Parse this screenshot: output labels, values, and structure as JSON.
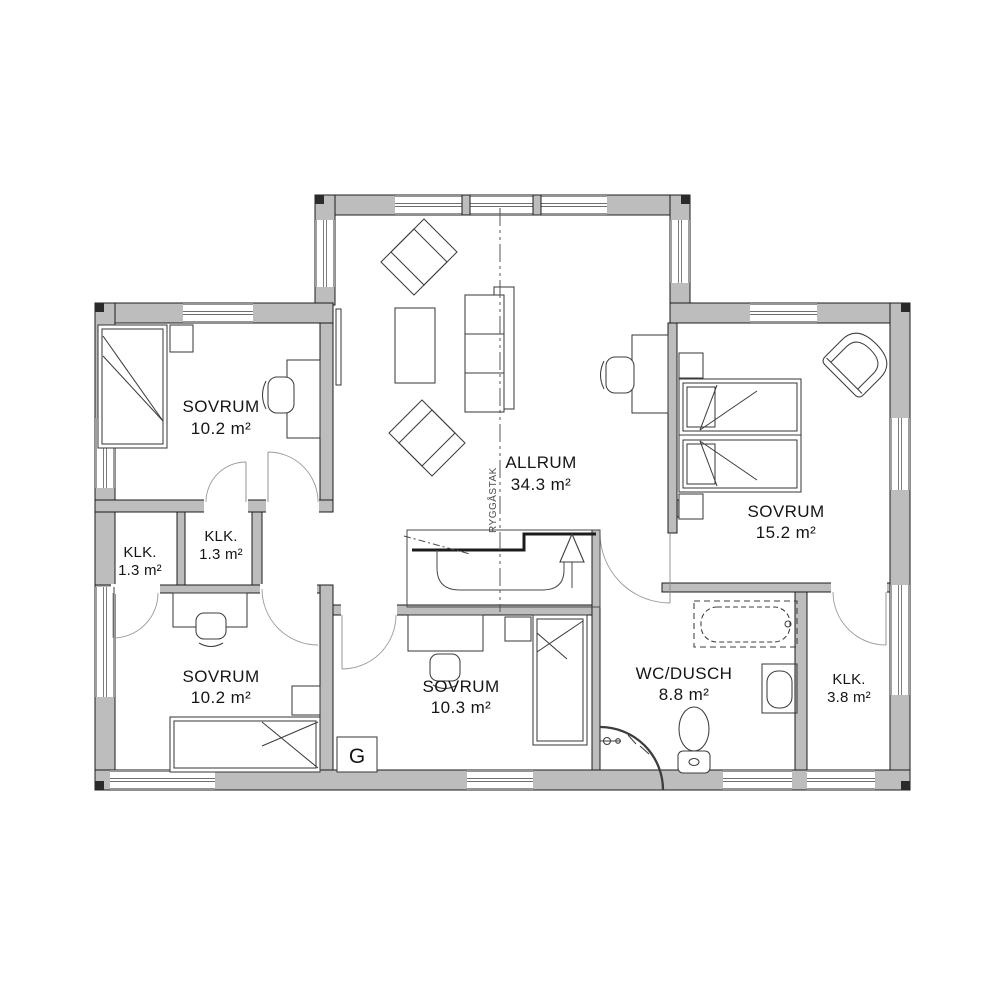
{
  "floorplan": {
    "rooms": [
      {
        "id": "sovrum-nw",
        "name": "SOVRUM",
        "area": "10.2 m²"
      },
      {
        "id": "klk-west",
        "name": "KLK.",
        "area": "1.3 m²"
      },
      {
        "id": "klk-mid",
        "name": "KLK.",
        "area": "1.3 m²"
      },
      {
        "id": "sovrum-sw",
        "name": "SOVRUM",
        "area": "10.2 m²"
      },
      {
        "id": "sovrum-south",
        "name": "SOVRUM",
        "area": "10.3 m²"
      },
      {
        "id": "allrum",
        "name": "ALLRUM",
        "area": "34.3 m²"
      },
      {
        "id": "sovrum-east",
        "name": "SOVRUM",
        "area": "15.2 m²"
      },
      {
        "id": "wc-dusch",
        "name": "WC/DUSCH",
        "area": "8.8 m²"
      },
      {
        "id": "klk-southeast",
        "name": "KLK.",
        "area": "3.8 m²"
      }
    ],
    "annotations": {
      "ridge_line_label": "RYGGÅSTAK",
      "wardrobe_label": "G",
      "stair_direction": "up"
    },
    "colors": {
      "wall_fill": "#bdbdbd",
      "outline": "#1c1c1c",
      "furniture_line": "#3d3d3d",
      "background": "#ffffff"
    }
  }
}
